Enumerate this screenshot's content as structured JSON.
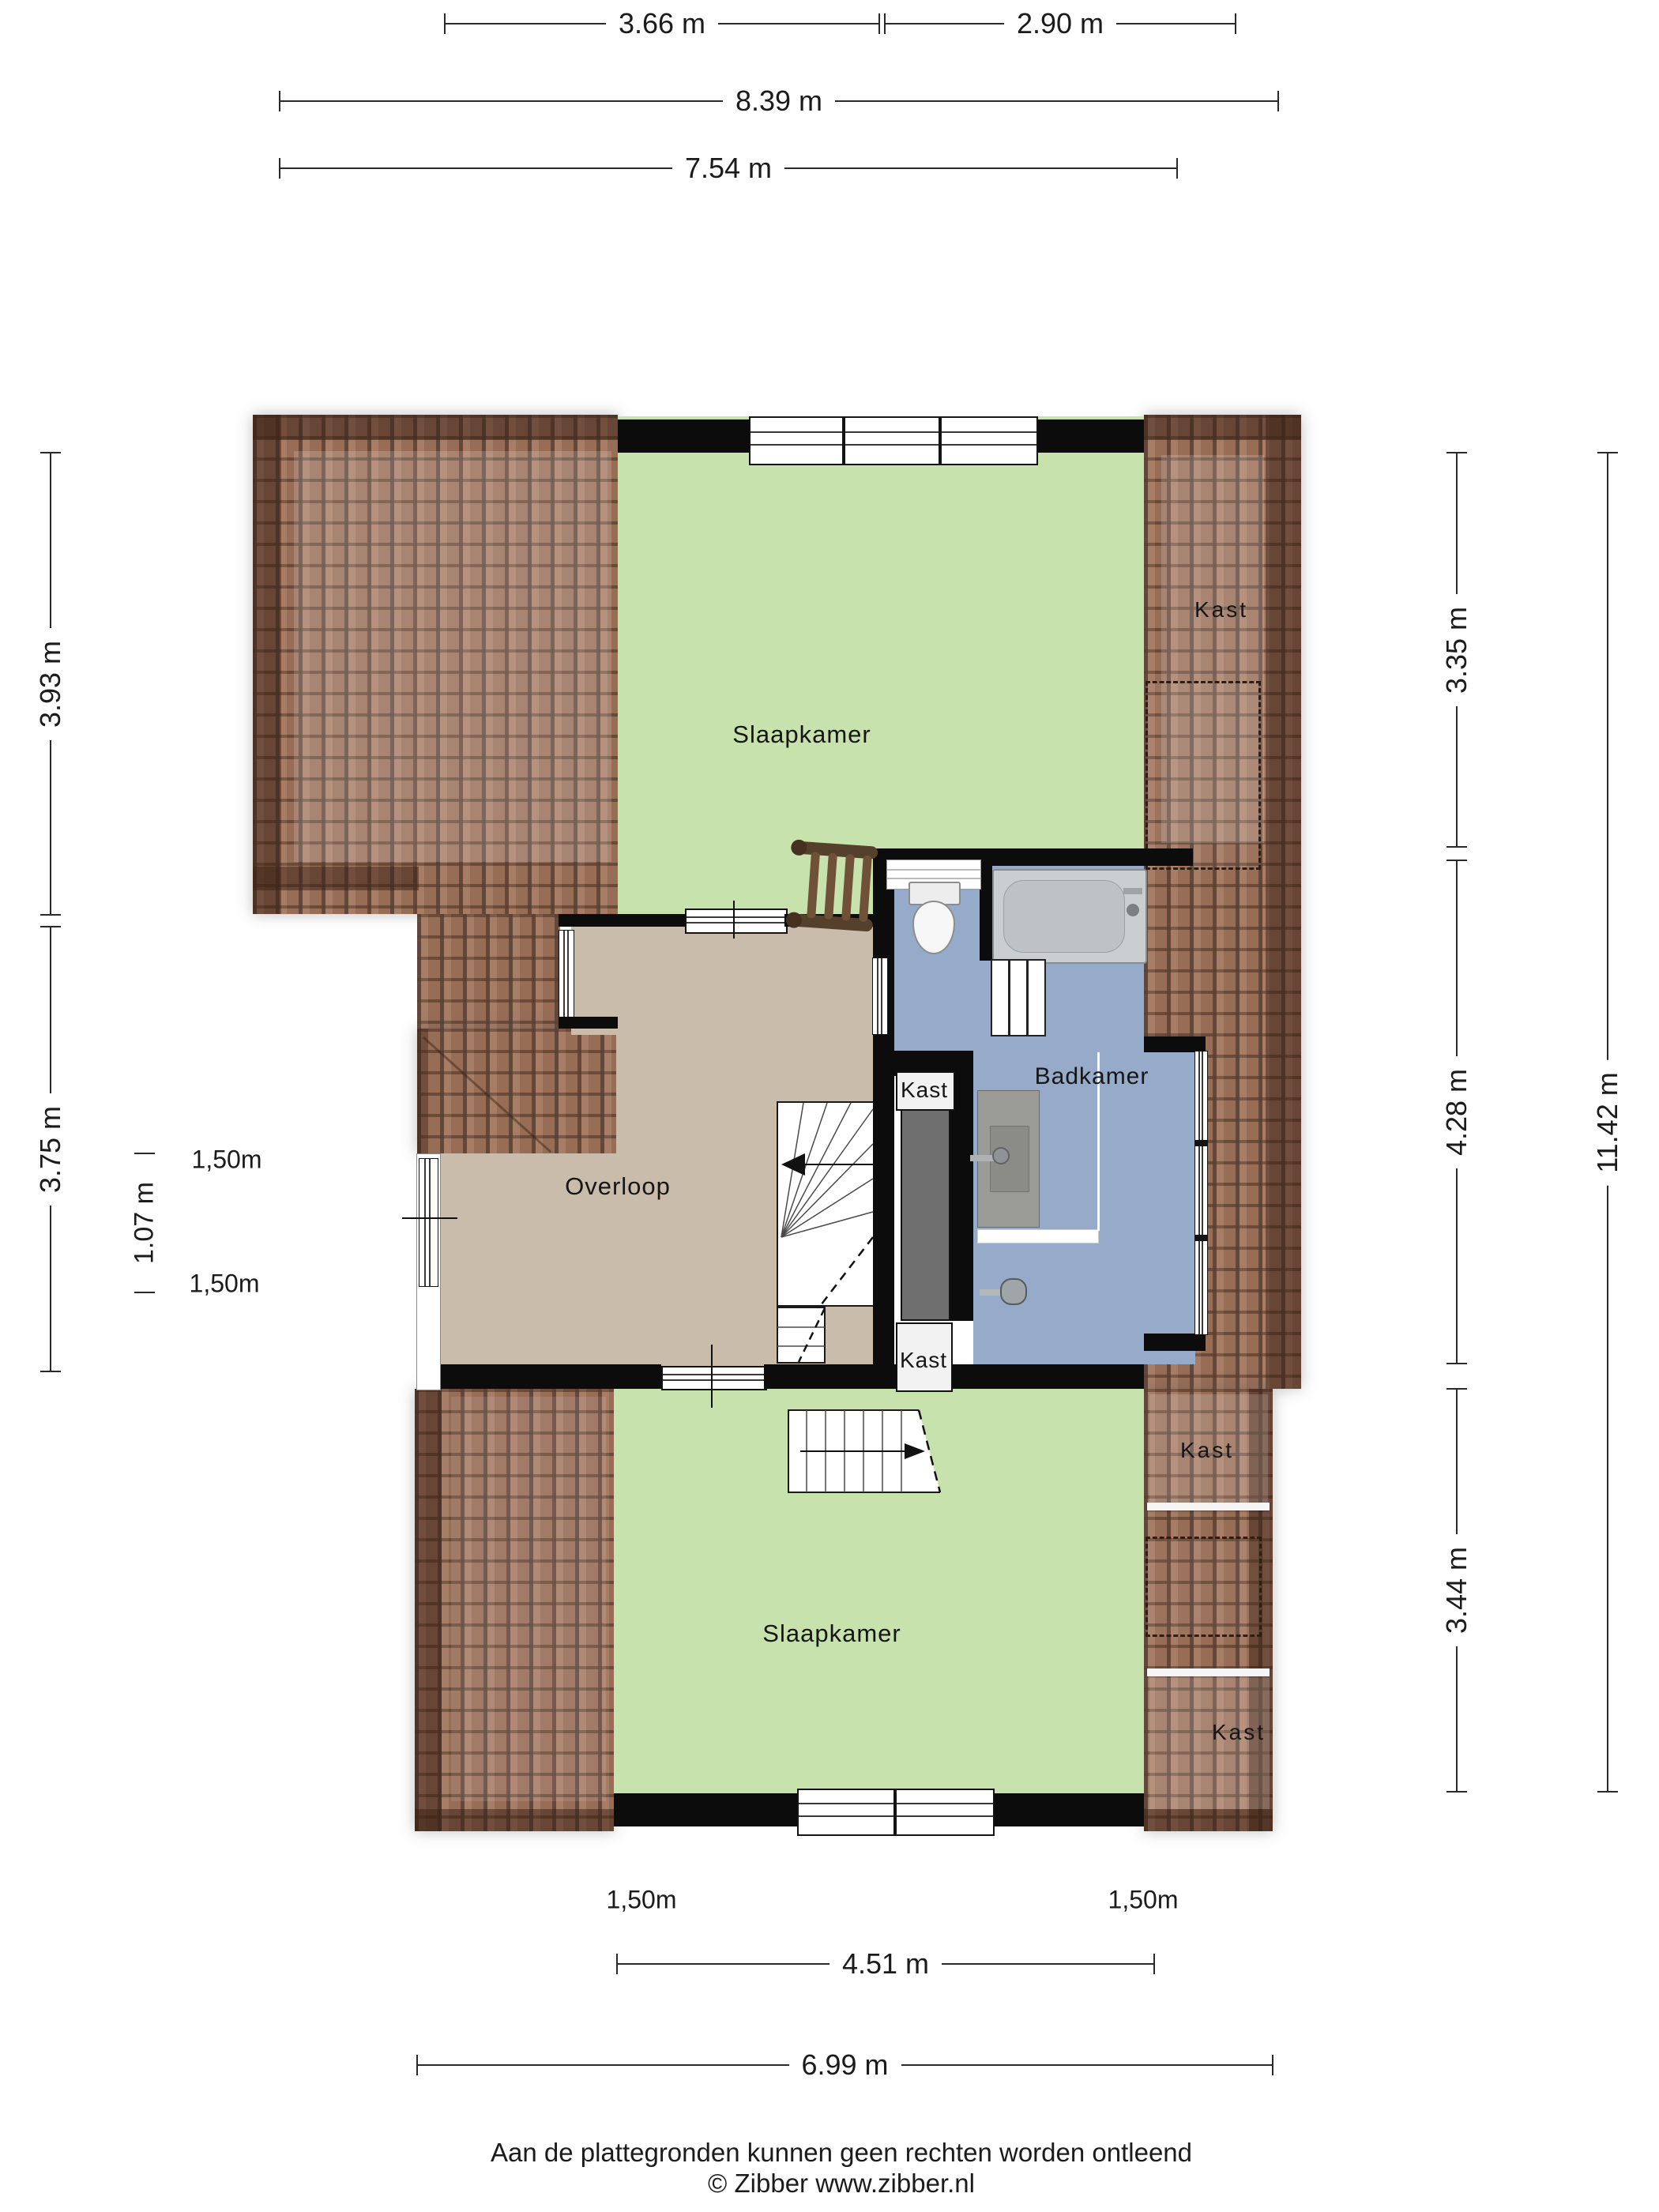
{
  "rooms": {
    "bedroom_top": "Slaapkamer",
    "bedroom_bottom": "Slaapkamer",
    "landing": "Overloop",
    "bathroom": "Badkamer",
    "closet_roof_top_right": "Kast",
    "closet_shaft_upper": "Kast",
    "closet_shaft_lower": "Kast",
    "closet_right_mid": "Kast",
    "closet_right_bottom": "Kast"
  },
  "dimensions": {
    "top": [
      {
        "label": "3.66 m"
      },
      {
        "label": "2.90 m"
      },
      {
        "label": "8.39 m"
      },
      {
        "label": "7.54 m"
      }
    ],
    "left": [
      {
        "label": "3.93 m"
      },
      {
        "label": "3.75 m"
      },
      {
        "label": "1.07 m"
      }
    ],
    "right": [
      {
        "label": "3.35 m"
      },
      {
        "label": "4.28 m"
      },
      {
        "label": "3.44 m"
      },
      {
        "label": "11.42 m"
      }
    ],
    "bottom": [
      {
        "label": "4.51 m"
      },
      {
        "label": "6.99 m"
      }
    ],
    "height_lines": [
      {
        "label": "1,50m"
      },
      {
        "label": "1,50m"
      },
      {
        "label": "1,50m"
      },
      {
        "label": "1,50m"
      }
    ]
  },
  "footer": {
    "line1": "Aan de plattegronden kunnen geen rechten worden ontleend",
    "line2": "© Zibber www.zibber.nl"
  },
  "colors": {
    "bedroom_green": "#c8e2ad",
    "landing_tan": "#cabcaa",
    "bathroom_blue": "#96abc9",
    "roof_brown": "#a3755d",
    "wall_black": "#0c0c0c",
    "shaft_gray": "#6f6f6f"
  }
}
